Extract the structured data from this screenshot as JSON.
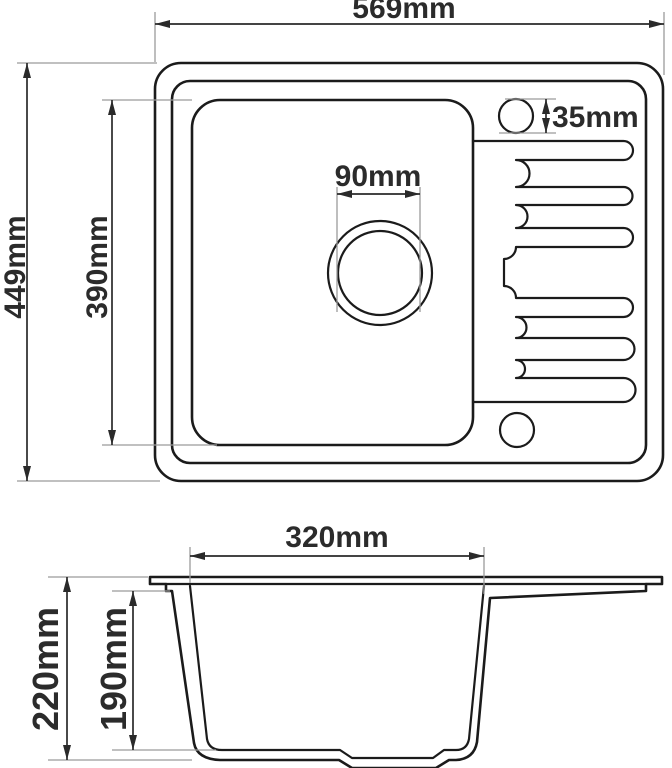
{
  "colors": {
    "background": "#ffffff",
    "outline": "#1b1b1b",
    "dimension_lines": "#2a2a2a",
    "extension_lines": "#9b9b9b",
    "label_text": "#2b2b2b"
  },
  "top_view": {
    "overall_width": "569mm",
    "overall_depth": "449mm",
    "bowl_length": "390mm",
    "drain_diameter": "90mm",
    "tap_hole_diameter": "35mm"
  },
  "side_view": {
    "bowl_width": "320mm",
    "overall_height": "220mm",
    "bowl_depth": "190mm"
  }
}
